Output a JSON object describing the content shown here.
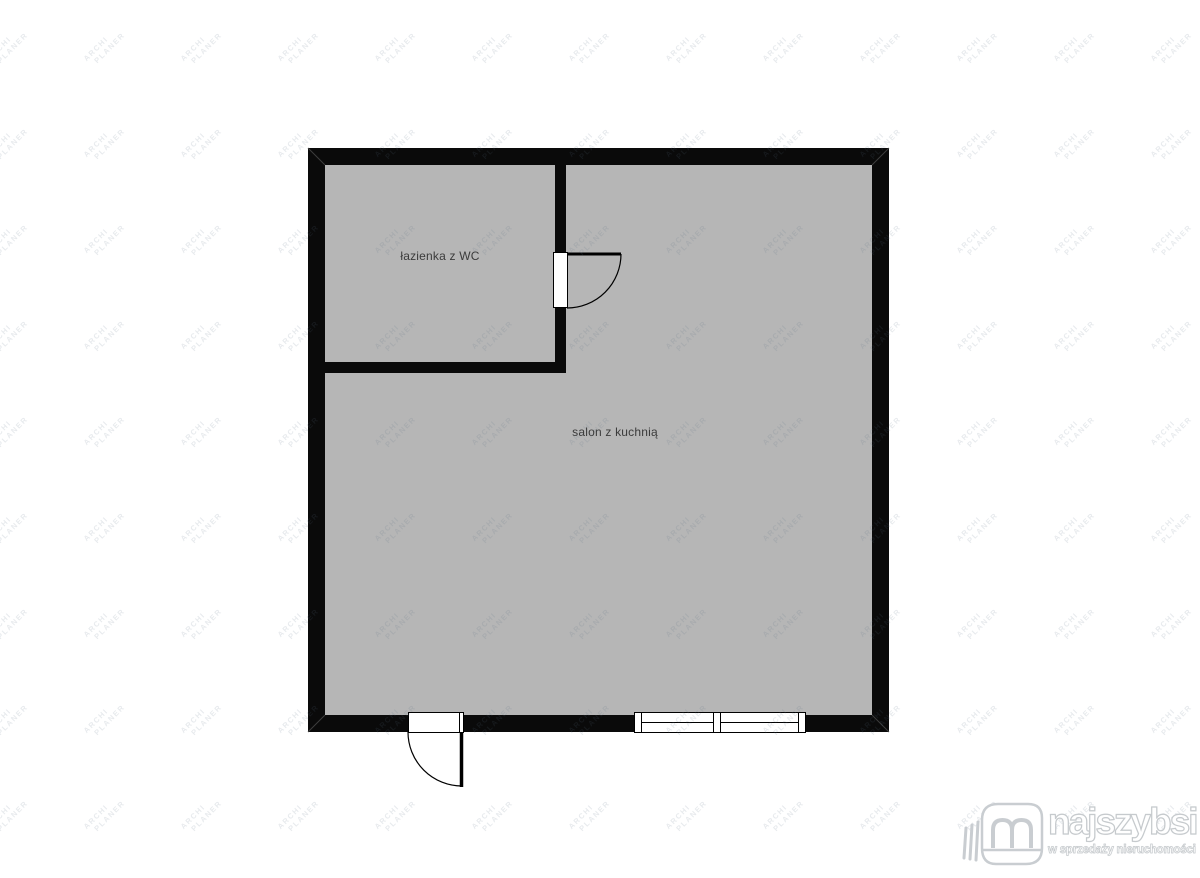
{
  "page": {
    "background": "#ffffff"
  },
  "floorplan": {
    "wall_color": "#0a0a0a",
    "floor_color": "#b6b6b6",
    "rooms": [
      {
        "id": "bathroom",
        "label": "łazienka z WC"
      },
      {
        "id": "salon-kitchen",
        "label": "salon z kuchnią"
      }
    ]
  },
  "watermark": {
    "line1": "ARCHI",
    "line2": "PLANER",
    "color": "rgba(96,112,134,0.15)"
  },
  "logo": {
    "title": "najszybsi",
    "subtitle": "w sprzedaży nieruchomości"
  }
}
